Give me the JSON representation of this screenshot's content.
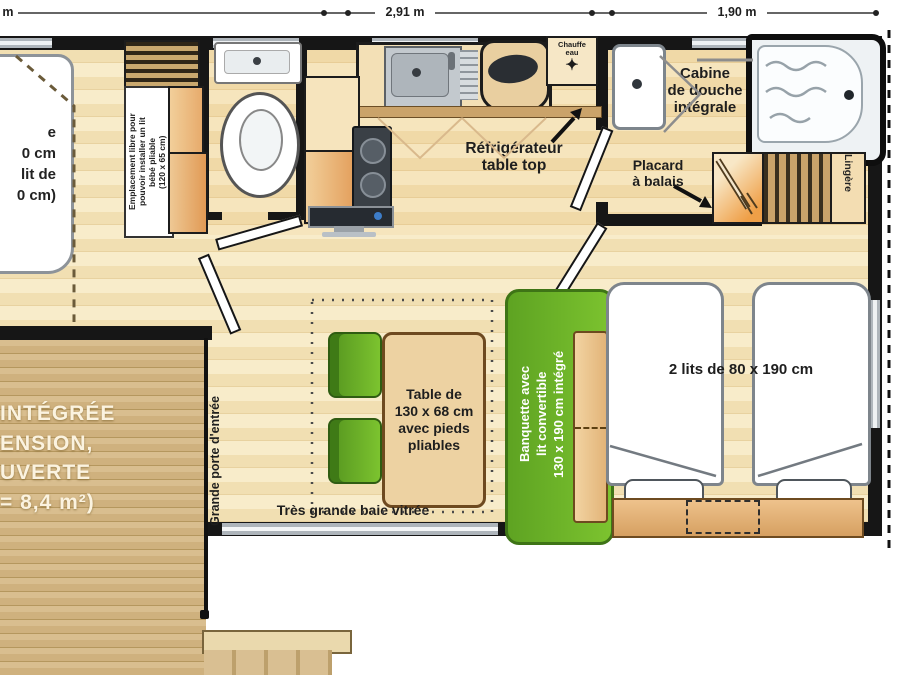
{
  "colors": {
    "accent_green": "#6fb52c",
    "wood": "#d9be8f",
    "floor": "#f6e8c6",
    "cabinet_orange": "#eaa766",
    "wall": "#161616"
  },
  "dimensions": {
    "left": "5 m",
    "mid": "2,91 m",
    "right": "1,90 m"
  },
  "master_bedroom": {
    "bed_fragments": [
      "e",
      "0 cm",
      "lit de",
      "0 cm)"
    ],
    "note_lines": [
      "Emplacement libre pour",
      "pouvoir installer un lit",
      "bébé pliable",
      "(120 x 65 cm)"
    ]
  },
  "kitchen": {
    "fridge_label_lines": [
      "Réfrigérateur",
      "table top"
    ],
    "water_heater_lines": [
      "Chauffe",
      "eau"
    ],
    "water_heater_icon_char": "✦"
  },
  "bathroom": {
    "shower_label_lines": [
      "Cabine",
      "de douche",
      "intégrale"
    ],
    "broom_label_lines": [
      "Placard",
      "à balais"
    ],
    "linen_label": "Lingère"
  },
  "living": {
    "entry_label": "Grande porte d'entrée",
    "bay_label": "Très grande baie vitrée",
    "table_label_lines": [
      "Table de",
      "130 x 68 cm",
      "avec pieds",
      "pliables"
    ],
    "banquette_label_lines": [
      "Banquette avec",
      "lit convertible",
      "130 x 190 cm intégré"
    ]
  },
  "bedroom2": {
    "beds_label": "2 lits de 80 x 190 cm"
  },
  "terrace": {
    "text_lines": [
      "INTÉGRÉE",
      "ENSION,",
      "UVERTE",
      "= 8,4 m²)"
    ]
  }
}
